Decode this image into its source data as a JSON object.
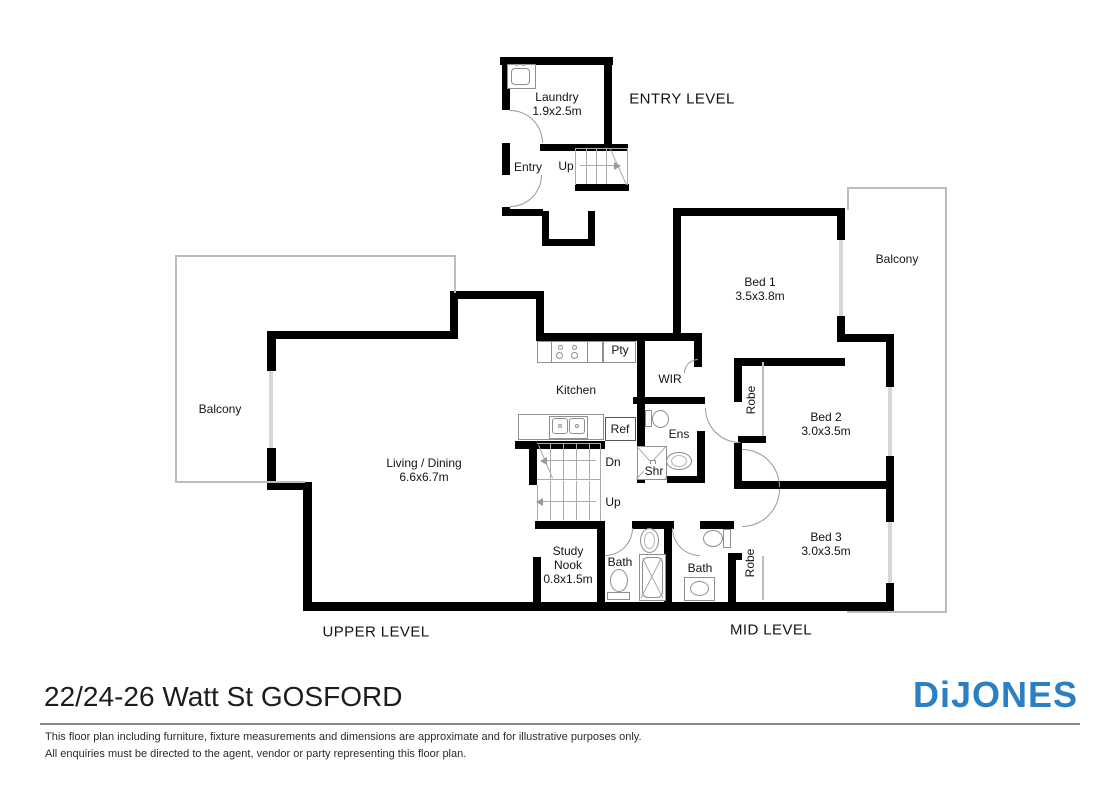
{
  "floorplan": {
    "address": "22/24-26 Watt St GOSFORD",
    "brand": "DiJONES",
    "brand_color": "#2a80c2",
    "disclaimer": [
      "This floor plan including furniture, fixture measurements and dimensions are approximate and for illustrative purposes only.",
      "All enquiries must be directed to the agent, vendor or party representing this floor plan."
    ],
    "levels": {
      "entry": "ENTRY LEVEL",
      "upper": "UPPER LEVEL",
      "mid": "MID LEVEL"
    },
    "rooms": {
      "laundry": {
        "label": "Laundry",
        "dims": "1.9x2.5m"
      },
      "entry_hall": {
        "label": "Entry"
      },
      "up_entry": {
        "label": "Up"
      },
      "bed1": {
        "label": "Bed 1",
        "dims": "3.5x3.8m"
      },
      "bed2": {
        "label": "Bed 2",
        "dims": "3.0x3.5m"
      },
      "bed3": {
        "label": "Bed 3",
        "dims": "3.0x3.5m"
      },
      "balcony_left": {
        "label": "Balcony"
      },
      "balcony_right": {
        "label": "Balcony"
      },
      "kitchen": {
        "label": "Kitchen"
      },
      "pty": {
        "label": "Pty"
      },
      "wir": {
        "label": "WIR"
      },
      "ref": {
        "label": "Ref"
      },
      "ens": {
        "label": "Ens"
      },
      "shr": {
        "label": "Shr"
      },
      "dn": {
        "label": "Dn"
      },
      "up_main": {
        "label": "Up"
      },
      "living": {
        "label": "Living / Dining",
        "dims": "6.6x6.7m"
      },
      "study": {
        "label": "Study Nook",
        "dims": "0.8x1.5m"
      },
      "bath1": {
        "label": "Bath"
      },
      "bath2": {
        "label": "Bath"
      },
      "robe_bed2": {
        "label": "Robe"
      },
      "robe_bed3": {
        "label": "Robe"
      }
    }
  }
}
